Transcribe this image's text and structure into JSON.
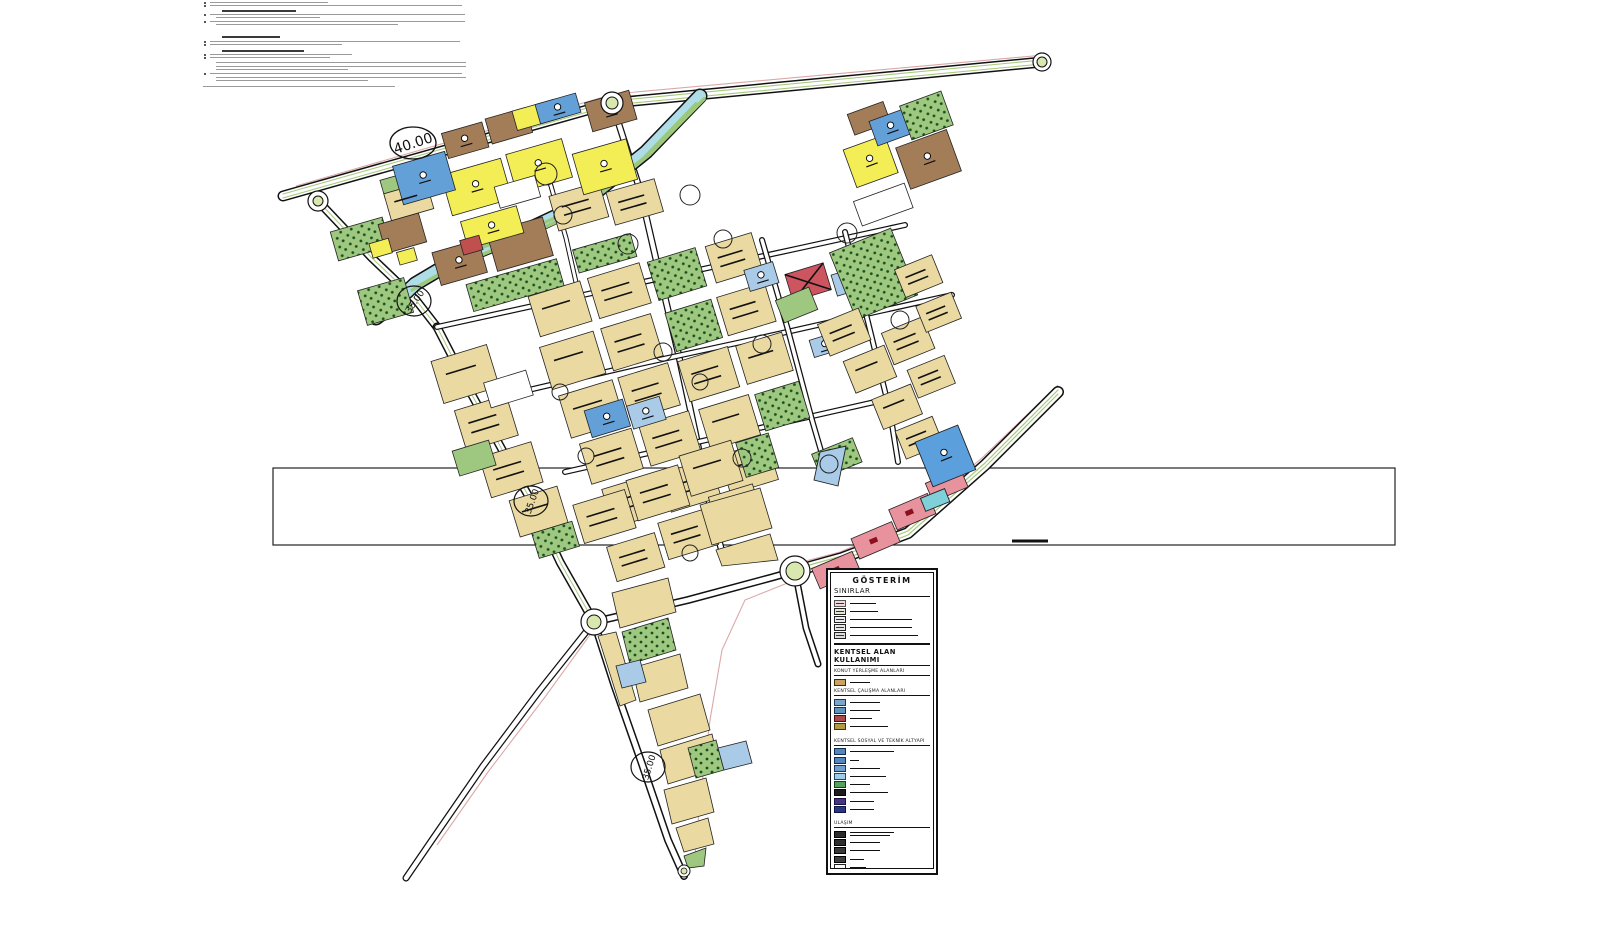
{
  "page": {
    "background": "#ffffff",
    "kind": "urban development plan sheet (imar planı)"
  },
  "notes": {
    "description": "plan notes paragraph block, micro-text illegible at this resolution",
    "lines": [
      {
        "x": 210,
        "y": 2,
        "w": 118,
        "t": "bullet"
      },
      {
        "x": 210,
        "y": 5,
        "w": 252,
        "t": "bullet"
      },
      {
        "x": 222,
        "y": 10,
        "w": 74,
        "t": "header"
      },
      {
        "x": 210,
        "y": 14,
        "w": 255,
        "t": "bullet"
      },
      {
        "x": 216,
        "y": 17,
        "w": 104,
        "t": "text"
      },
      {
        "x": 210,
        "y": 21,
        "w": 255,
        "t": "bullet"
      },
      {
        "x": 216,
        "y": 24,
        "w": 182,
        "t": "text"
      },
      {
        "x": 222,
        "y": 36,
        "w": 58,
        "t": "header"
      },
      {
        "x": 210,
        "y": 41,
        "w": 250,
        "t": "bullet"
      },
      {
        "x": 210,
        "y": 44,
        "w": 132,
        "t": "bullet"
      },
      {
        "x": 222,
        "y": 50,
        "w": 82,
        "t": "header"
      },
      {
        "x": 210,
        "y": 54,
        "w": 142,
        "t": "bullet"
      },
      {
        "x": 210,
        "y": 57,
        "w": 120,
        "t": "bullet"
      },
      {
        "x": 216,
        "y": 62,
        "w": 250,
        "t": "text"
      },
      {
        "x": 216,
        "y": 66,
        "w": 250,
        "t": "text"
      },
      {
        "x": 216,
        "y": 69,
        "w": 132,
        "t": "text"
      },
      {
        "x": 210,
        "y": 73,
        "w": 252,
        "t": "bullet"
      },
      {
        "x": 216,
        "y": 77,
        "w": 250,
        "t": "text"
      },
      {
        "x": 216,
        "y": 80,
        "w": 152,
        "t": "text"
      },
      {
        "x": 203,
        "y": 86,
        "w": 192,
        "t": "text"
      }
    ]
  },
  "map": {
    "palette": {
      "residential_tan": "#ead9a0",
      "yellow_zone": "#f3ee55",
      "blue_zone": "#64a0d8",
      "light_blue_zone": "#a9cbe8",
      "brown_zone": "#a37c58",
      "red_zone": "#c0504d",
      "pink_commercial": "#e8929e",
      "park_green": "#9ec87f",
      "pale_green_median": "#d9e8ae",
      "river_cyan": "#aedde8",
      "road_white": "#ffffff",
      "casing_black": "#111111",
      "plan_boundary_pink": "#dba8a8"
    },
    "road_width_labels": [
      {
        "text": "40.00"
      },
      {
        "text": "35.00"
      },
      {
        "text": "35.00"
      },
      {
        "text": "35.00"
      }
    ]
  },
  "legend": {
    "title": "GÖSTERİM",
    "sections": [
      {
        "title": "SINIRLAR",
        "cls": "lg-sec-sub",
        "rule": true,
        "items": [
          {
            "c": "#f2dada",
            "b": "#555",
            "w": 26,
            "frame": true
          },
          {
            "c": "#e6e6d8",
            "b": "#222",
            "w": 28,
            "frame": true
          },
          {
            "c": "#ececec",
            "b": "#222",
            "w": 62,
            "frame": true
          },
          {
            "c": "#e8e8e8",
            "b": "#222",
            "w": 62,
            "frame": true
          },
          {
            "c": "#dddddd",
            "b": "#222",
            "w": 68,
            "frame": true
          }
        ]
      },
      {
        "title": "KENTSEL ALAN KULLANIMI",
        "cls": "lg-sec-main",
        "rule": true,
        "items": []
      },
      {
        "title": "KONUT YERLEŞME ALANLARI",
        "cls": "lg-sec-small",
        "rule": true,
        "items": [
          {
            "c": "#c9a35f",
            "b": "#3a2a10",
            "w": 20
          }
        ]
      },
      {
        "title": "KENTSEL ÇALIŞMA ALANLARI",
        "cls": "lg-sec-small",
        "rule": true,
        "items": [
          {
            "c": "#7ba6cc",
            "b": "#1a3a5c",
            "w": 30
          },
          {
            "c": "#5e93bd",
            "b": "#12304d",
            "w": 30
          },
          {
            "c": "#a84848",
            "b": "#401010",
            "w": 22
          },
          {
            "c": "#b09a48",
            "b": "#403310",
            "w": 38
          }
        ]
      },
      {
        "title": "KENTSEL SOSYAL VE TEKNİK ALTYAPI",
        "cls": "lg-sec-small",
        "rule": true,
        "gap": true,
        "items": [
          {
            "c": "#5585bd",
            "b": "#0f2d52",
            "w": 44
          },
          {
            "c": "#5585bd",
            "b": "#0f2d52",
            "w": 9
          },
          {
            "c": "#6f9fcf",
            "b": "#16365c",
            "w": 30
          },
          {
            "c": "#9fcfe8",
            "b": "#1a4a66",
            "w": 36
          },
          {
            "c": "#55a05c",
            "b": "#123f16",
            "w": 20
          },
          {
            "c": "#1c1c1c",
            "b": "#000000",
            "w": 38
          },
          {
            "c": "#453585",
            "b": "#1a1040",
            "w": 24
          },
          {
            "c": "#2a3585",
            "b": "#101540",
            "w": 24
          }
        ]
      },
      {
        "title": "ULAŞIM",
        "cls": "lg-sec-small",
        "rule": true,
        "gap": true,
        "items": [
          {
            "c": "#2a2a2a",
            "b": "#000000",
            "w": 44,
            "w2": 40
          },
          {
            "c": "#2e2e2e",
            "b": "#000000",
            "w": 30
          },
          {
            "c": "#383838",
            "b": "#000000",
            "w": 30
          },
          {
            "c": "#404040",
            "b": "#000000",
            "w": 14
          },
          {
            "c": "#ffffff",
            "b": "#222222",
            "w": 16
          },
          {
            "c": "#f4f4f4",
            "b": "#222222",
            "w": 16
          }
        ]
      }
    ]
  }
}
